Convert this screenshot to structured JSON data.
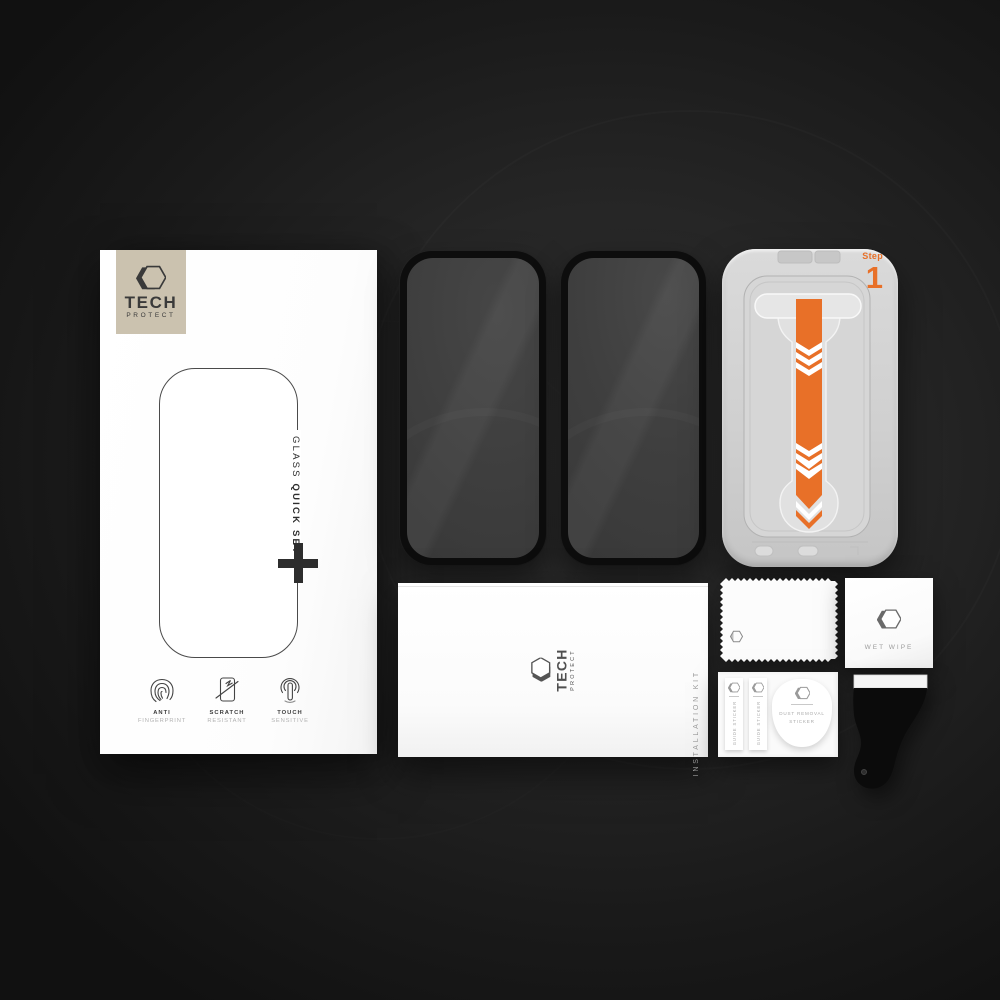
{
  "brand": {
    "name": "TECH",
    "subname": "PROTECT"
  },
  "retail_box": {
    "glass_label": "GLASS",
    "quickset_label": "QUICK SET",
    "features": [
      {
        "title": "ANTI",
        "subtitle": "FINGERPRINT"
      },
      {
        "title": "SCRATCH",
        "subtitle": "RESISTANT"
      },
      {
        "title": "TOUCH",
        "subtitle": "SENSITIVE"
      }
    ]
  },
  "install_tray": {
    "step_label": "Step",
    "step_number": "1"
  },
  "installation_kit": {
    "side_label": "INSTALLATION KIT"
  },
  "wet_wipe": {
    "label": "WET WIPE"
  },
  "sticker_card": {
    "guide_sticker_1": "GUIDE STICKER",
    "guide_sticker_2": "GUIDE STICKER",
    "dust_removal_line1": "DUST REMOVAL",
    "dust_removal_line2": "STICKER"
  },
  "icons": {
    "brand_logo": "hexagon-3d",
    "feature_1": "fingerprint",
    "feature_2": "scratch-resistant-screen",
    "feature_3": "touch-sensitive-finger",
    "tray_stripe": "pull-down-arrow",
    "box_cross": "plus-crosshair"
  },
  "colors": {
    "accent_orange": "#E87028",
    "logo_plate_beige": "#CBC2AF",
    "glass_surface": "#3E3E3E",
    "tray_gray": "#D2D2D2",
    "background": "#1C1C1C"
  }
}
